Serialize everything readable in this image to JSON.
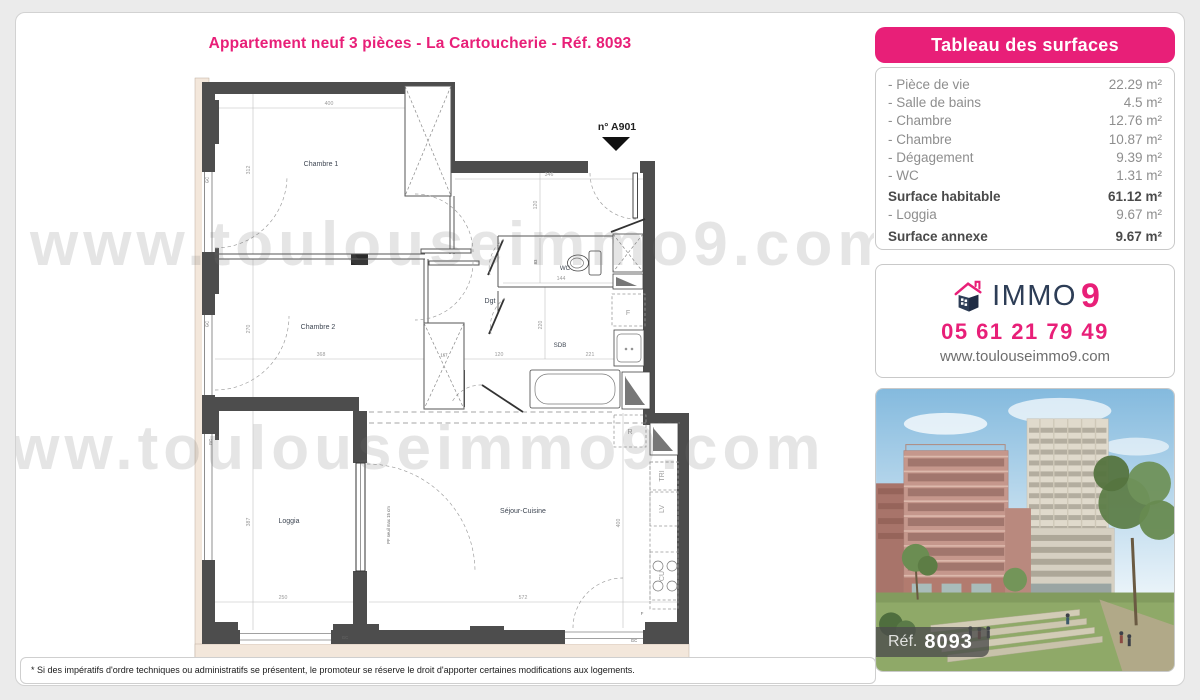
{
  "colors": {
    "accent_pink": "#e81f78",
    "navy": "#2d3d56",
    "wall_gray": "#4d4d4d",
    "facade_beige": "#f3e7db"
  },
  "title": "Appartement neuf 3 pièces - La Cartoucherie - Réf. 8093",
  "watermark": {
    "text": "www.toulouseimmo9.com"
  },
  "floorplan": {
    "unit_label": "n° A901",
    "rooms": {
      "chambre1": "Chambre 1",
      "chambre2": "Chambre 2",
      "dgt": "Dgt",
      "wc": "WC",
      "sdb": "SDB",
      "sejour": "Séjour-Cuisine",
      "loggia": "Loggia"
    },
    "dims": {
      "d400_top": "400",
      "d312": "312",
      "d346": "346",
      "d120_v": "120",
      "d83": "83",
      "d144": "144",
      "d270": "270",
      "d368": "368",
      "d167": "167",
      "d120_h": "120",
      "d221": "221",
      "d220": "220",
      "d387": "387",
      "d250": "250",
      "d572": "572",
      "d400_right": "400"
    },
    "labels": {
      "gc": "GC",
      "f": "F",
      "f_small": "F",
      "r": "R",
      "tri": "TRI",
      "lv": "LV",
      "cu": "CU",
      "pf": "PF seuil max 15 cm"
    }
  },
  "surface_table": {
    "header": "Tableau des surfaces",
    "rows": [
      {
        "label": "- Pièce de vie",
        "value": "22.29 m²",
        "bold": false
      },
      {
        "label": "- Salle de bains",
        "value": "4.5 m²",
        "bold": false
      },
      {
        "label": "- Chambre",
        "value": "12.76 m²",
        "bold": false
      },
      {
        "label": "- Chambre",
        "value": "10.87 m²",
        "bold": false
      },
      {
        "label": "- Dégagement",
        "value": "9.39 m²",
        "bold": false
      },
      {
        "label": "- WC",
        "value": "1.31 m²",
        "bold": false
      },
      {
        "label": "Surface habitable",
        "value": "61.12 m²",
        "bold": true
      },
      {
        "label": "- Loggia",
        "value": "9.67 m²",
        "bold": false
      },
      {
        "label": "Surface annexe",
        "value": "9.67 m²",
        "bold": true
      }
    ]
  },
  "agency": {
    "brand": "IMMO",
    "brand_number": "9",
    "phone": "05 61 21 79 49",
    "website": "www.toulouseimmo9.com"
  },
  "photo": {
    "ref_label": "Réf.",
    "ref_value": "8093"
  },
  "footnote": "* Si des impératifs d'ordre techniques ou administratifs se présentent, le promoteur se réserve le droit d'apporter certaines modifications aux logements."
}
